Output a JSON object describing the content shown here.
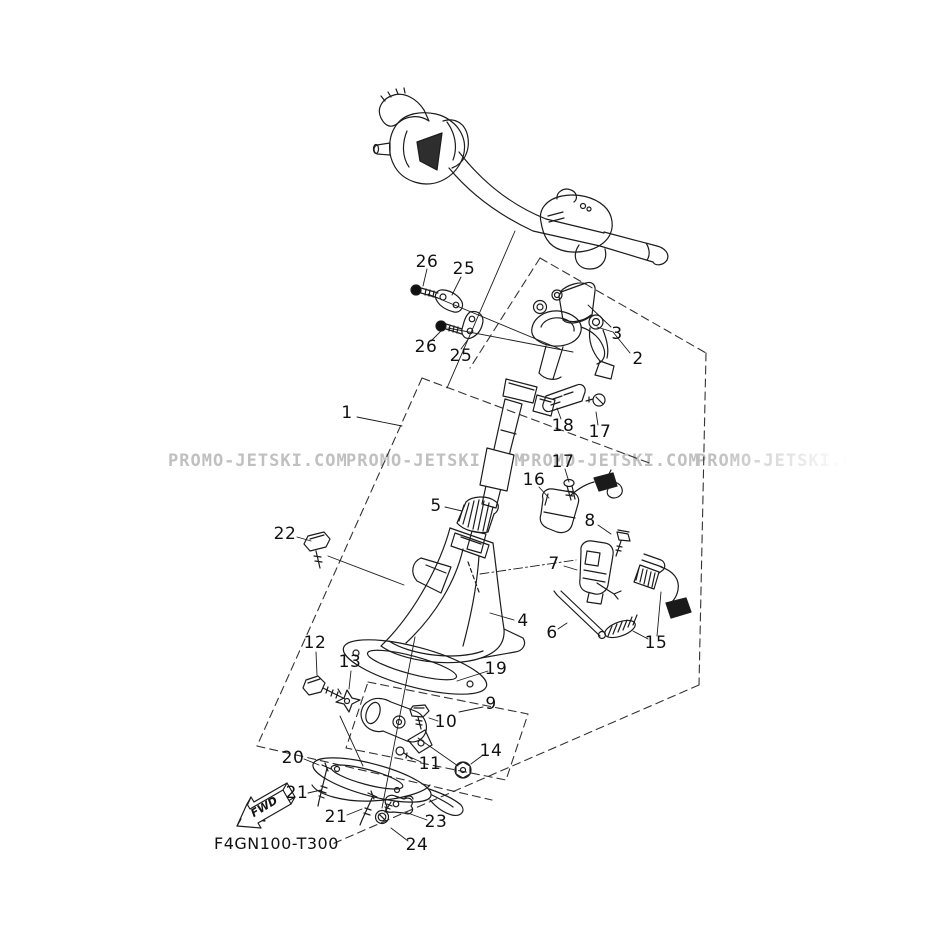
{
  "diagram": {
    "watermark": {
      "text": "PROMO-JETSKI.COM",
      "color": "#c0c0c0"
    },
    "part_code": "F4GN100-T300",
    "fwd_label": "FWD",
    "ink_color": "#1c1c1c",
    "background": "#ffffff",
    "labels": [
      "26",
      "25",
      "26",
      "25",
      "3",
      "2",
      "1",
      "18",
      "17",
      "17",
      "16",
      "5",
      "22",
      "8",
      "7",
      "4",
      "6",
      "15",
      "12",
      "13",
      "19",
      "9",
      "10",
      "14",
      "11",
      "20",
      "21",
      "21",
      "23",
      "24"
    ]
  }
}
